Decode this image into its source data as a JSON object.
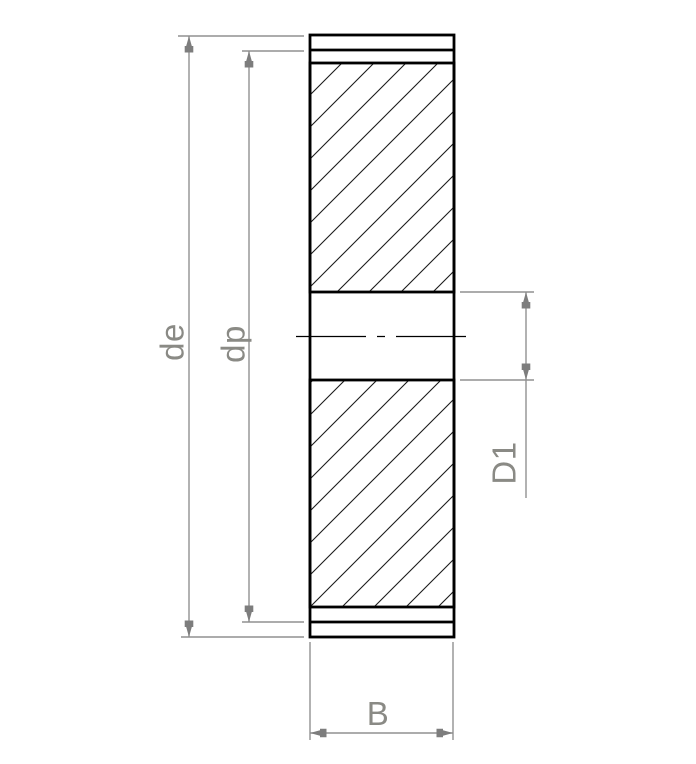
{
  "drawing": {
    "title": "Spur gear cross-section technical drawing",
    "view": "Side section view with hatched gear body, bore and centerline",
    "dimensions": {
      "outer_diameter": {
        "label": "de",
        "meaning": "external diameter dimension"
      },
      "pitch_diameter": {
        "label": "dp",
        "meaning": "pitch diameter dimension"
      },
      "bore_diameter": {
        "label": "D1",
        "meaning": "bore diameter dimension"
      },
      "face_width": {
        "label": "B",
        "meaning": "face width dimension"
      }
    }
  },
  "colors": {
    "background": "#ffffff",
    "object_line": "#000000",
    "hatch_line": "#1a1a1a",
    "dimension_line": "#919191",
    "dimension_arrow": "#7d7d7d",
    "dimension_text": "#8a8a85"
  }
}
